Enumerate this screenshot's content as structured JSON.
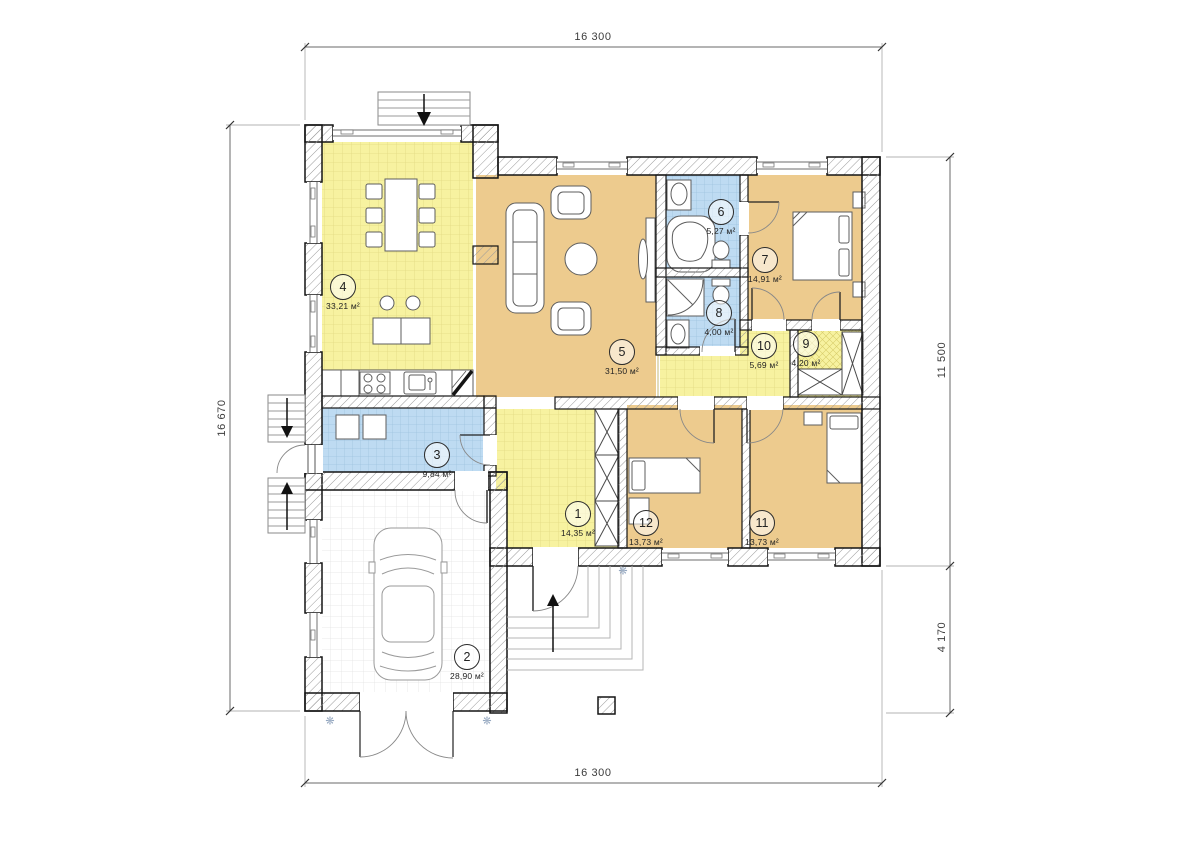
{
  "dimensions": {
    "top": "16 300",
    "bottom": "16 300",
    "left": "16 670",
    "right_upper": "11 500",
    "right_lower": "4 170"
  },
  "rooms": [
    {
      "number": "1",
      "area": "14,35 м²"
    },
    {
      "number": "2",
      "area": "28,90 м²"
    },
    {
      "number": "3",
      "area": "9,84 м²"
    },
    {
      "number": "4",
      "area": "33,21 м²"
    },
    {
      "number": "5",
      "area": "31,50 м²"
    },
    {
      "number": "6",
      "area": "5,27 м²"
    },
    {
      "number": "7",
      "area": "14,91 м²"
    },
    {
      "number": "8",
      "area": "4,00 м²"
    },
    {
      "number": "9",
      "area": "4,20 м²"
    },
    {
      "number": "10",
      "area": "5,69 м²"
    },
    {
      "number": "11",
      "area": "13,73 м²"
    },
    {
      "number": "12",
      "area": "13,73 м²"
    }
  ],
  "icons": {
    "ground_marker": "❋"
  },
  "colors": {
    "room_yellow": "#f7f2a0",
    "room_tan": "#edcb8e",
    "room_blue": "#bedbf2",
    "garage_white": "#ffffff",
    "wall_outline": "#141414",
    "hatch_line": "#9a9a9a",
    "dimension": "#3c3c3c"
  }
}
